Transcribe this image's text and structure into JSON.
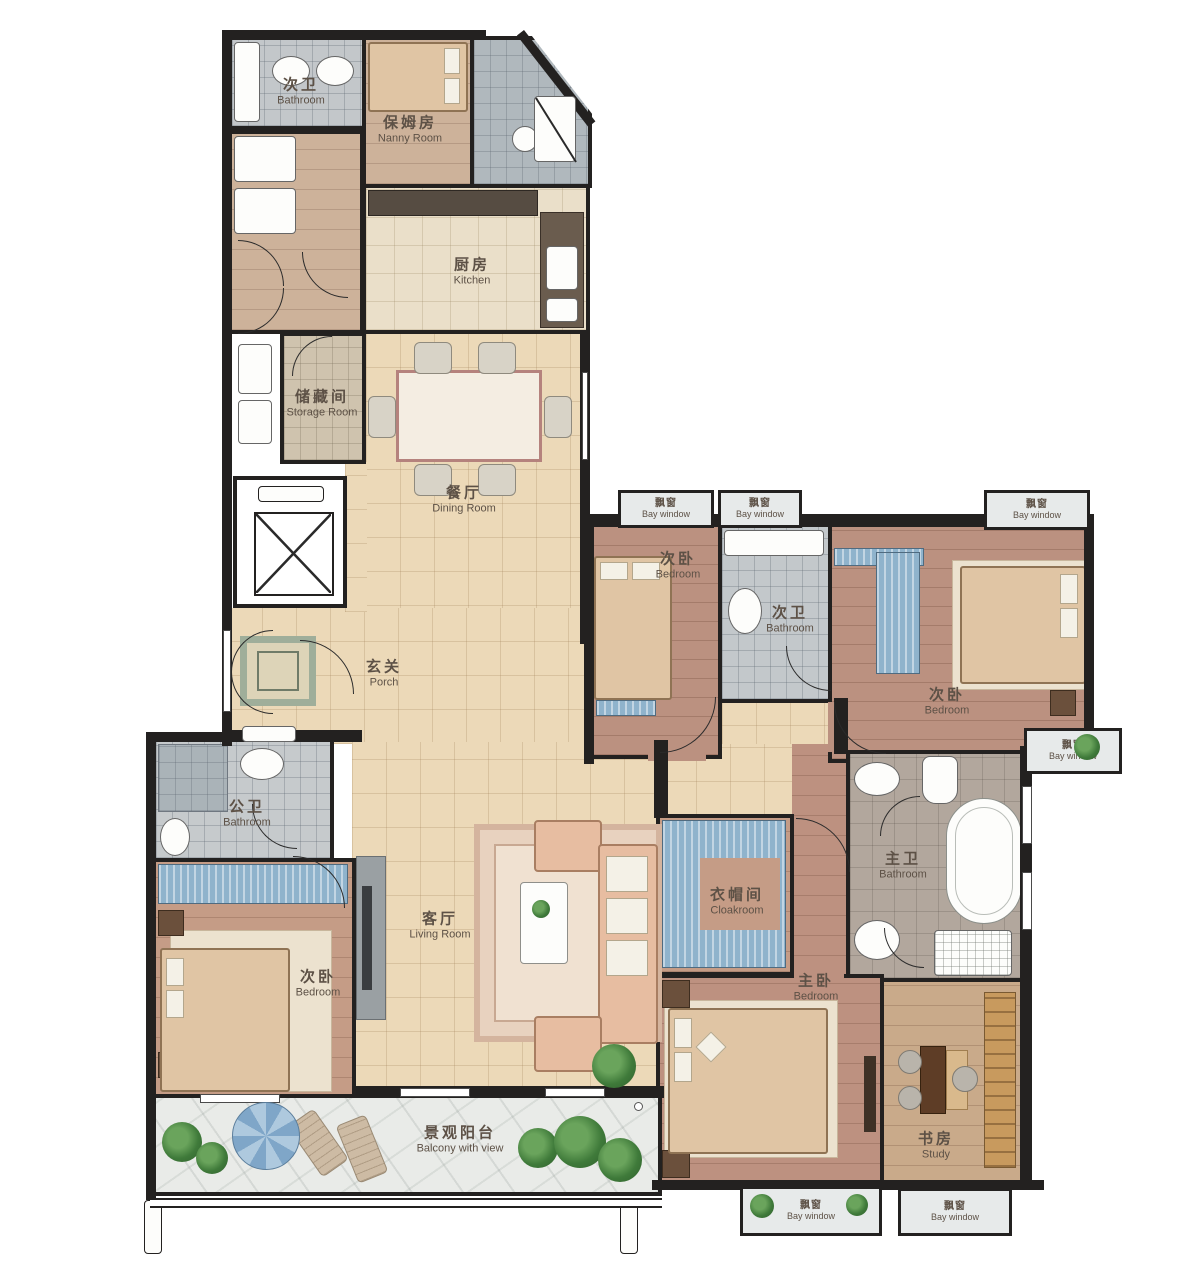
{
  "rooms": {
    "tl_bath": {
      "zh": "次卫",
      "en": "Bathroom"
    },
    "nanny": {
      "zh": "保姆房",
      "en": "Nanny Room"
    },
    "kitchen": {
      "zh": "厨房",
      "en": "Kitchen"
    },
    "storage": {
      "zh": "储藏间",
      "en": "Storage Room"
    },
    "dining": {
      "zh": "餐厅",
      "en": "Dining Room"
    },
    "porch": {
      "zh": "玄关",
      "en": "Porch"
    },
    "ne_bed1": {
      "zh": "次卧",
      "en": "Bedroom"
    },
    "ne_bath": {
      "zh": "次卫",
      "en": "Bathroom"
    },
    "ne_bed2": {
      "zh": "次卧",
      "en": "Bedroom"
    },
    "pub_bath": {
      "zh": "公卫",
      "en": "Bathroom"
    },
    "w_bed": {
      "zh": "次卧",
      "en": "Bedroom"
    },
    "living": {
      "zh": "客厅",
      "en": "Living Room"
    },
    "cloak": {
      "zh": "衣帽间",
      "en": "Cloakroom"
    },
    "m_bath": {
      "zh": "主卫",
      "en": "Bathroom"
    },
    "m_bed": {
      "zh": "主卧",
      "en": "Bedroom"
    },
    "study": {
      "zh": "书房",
      "en": "Study"
    },
    "balcony": {
      "zh": "景观阳台",
      "en": "Balcony with view"
    }
  },
  "bays": [
    {
      "zh": "飘窗",
      "en": "Bay window"
    },
    {
      "zh": "飘窗",
      "en": "Bay window"
    },
    {
      "zh": "飘窗",
      "en": "Bay window"
    },
    {
      "zh": "飘窗",
      "en": "Bay window"
    },
    {
      "zh": "飘窗",
      "en": "Bay window"
    },
    {
      "zh": "飘窗",
      "en": "Bay window"
    }
  ],
  "colors": {
    "wall": "#232120",
    "tile_floor": "#ecd9b8",
    "wood_floor": "#bd9180",
    "bath_tile": "#c3c8cb",
    "balcony_stone": "#e9ebe8",
    "accent_blue": "#8fb3cc",
    "label_text": "#5d5146"
  }
}
